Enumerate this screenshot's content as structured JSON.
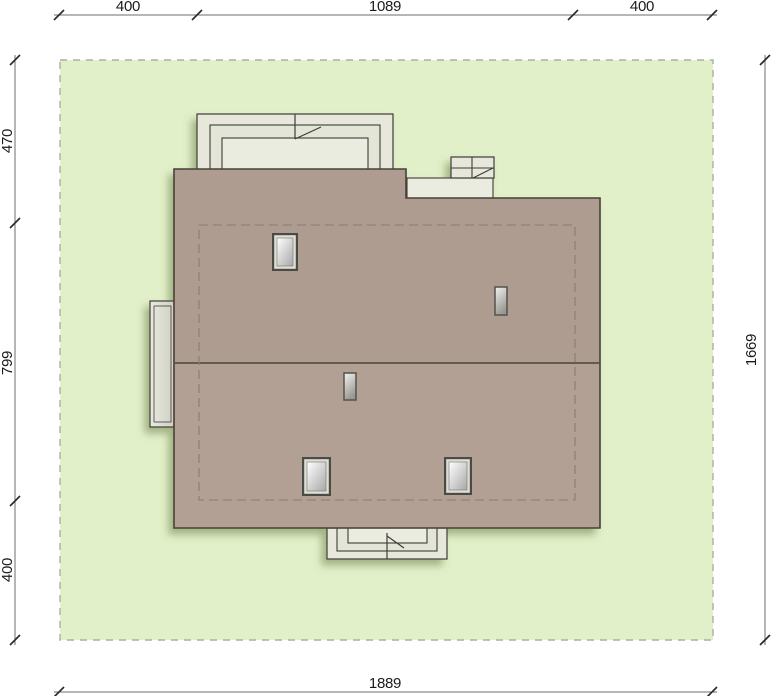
{
  "plan": {
    "title_hint": "house-site-plan-top-view",
    "dims": {
      "top": [
        "400",
        "1089",
        "400"
      ],
      "left": [
        "470",
        "799",
        "400"
      ],
      "right_total": "1669",
      "bottom_total": "1889"
    },
    "colors": {
      "plot_fill": "#e2f0ca",
      "plot_border": "#aab0a4",
      "roof_upper": "#ae9c90",
      "roof_lower": "#b2a094",
      "roof_outline": "#4a4038",
      "ridge": "#59514a",
      "eaves_dash": "#8b7d70",
      "structure_fill": "#e7e8db",
      "structure_outline": "#3c3c38",
      "dim_text": "#1b1b1b",
      "dim_line": "#6e6e6e",
      "shadow": "#64743e"
    }
  }
}
